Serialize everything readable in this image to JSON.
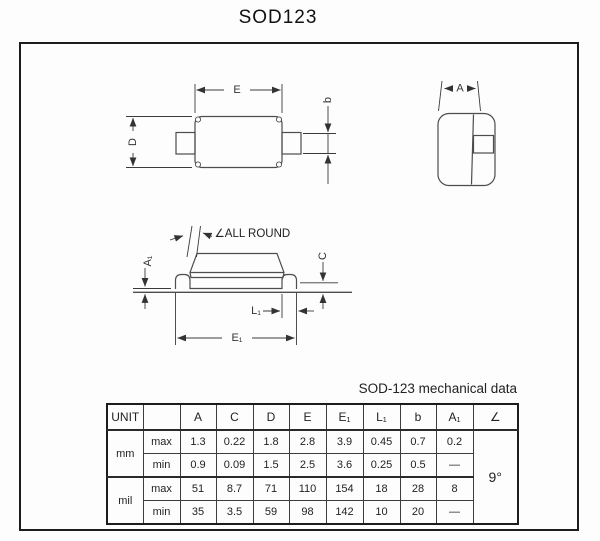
{
  "title": "SOD123",
  "subtitle": "SOD-123 mechanical data",
  "colors": {
    "line": "#4d4d4d",
    "dim": "#3a3a3a",
    "border": "#1c1c1c"
  },
  "diagram": {
    "labels": {
      "E": "E",
      "D": "D",
      "b": "b",
      "A": "A",
      "all_round": "∠ALL ROUND",
      "A1": "A₁",
      "C": "C",
      "L1": "L₁",
      "E1": "E₁"
    }
  },
  "table": {
    "unit_header": "UNIT",
    "limit_header": "",
    "col_headers": [
      "A",
      "C",
      "D",
      "E",
      "E₁",
      "L₁",
      "b",
      "A₁",
      "∠"
    ],
    "angle_value": "9°",
    "groups": [
      {
        "unit": "mm",
        "rows": [
          {
            "limit": "max",
            "values": [
              "1.3",
              "0.22",
              "1.8",
              "2.8",
              "3.9",
              "0.45",
              "0.7",
              "0.2"
            ]
          },
          {
            "limit": "min",
            "values": [
              "0.9",
              "0.09",
              "1.5",
              "2.5",
              "3.6",
              "0.25",
              "0.5",
              "—"
            ]
          }
        ]
      },
      {
        "unit": "mil",
        "rows": [
          {
            "limit": "max",
            "values": [
              "51",
              "8.7",
              "71",
              "110",
              "154",
              "18",
              "28",
              "8"
            ]
          },
          {
            "limit": "min",
            "values": [
              "35",
              "3.5",
              "59",
              "98",
              "142",
              "10",
              "20",
              "—"
            ]
          }
        ]
      }
    ]
  }
}
